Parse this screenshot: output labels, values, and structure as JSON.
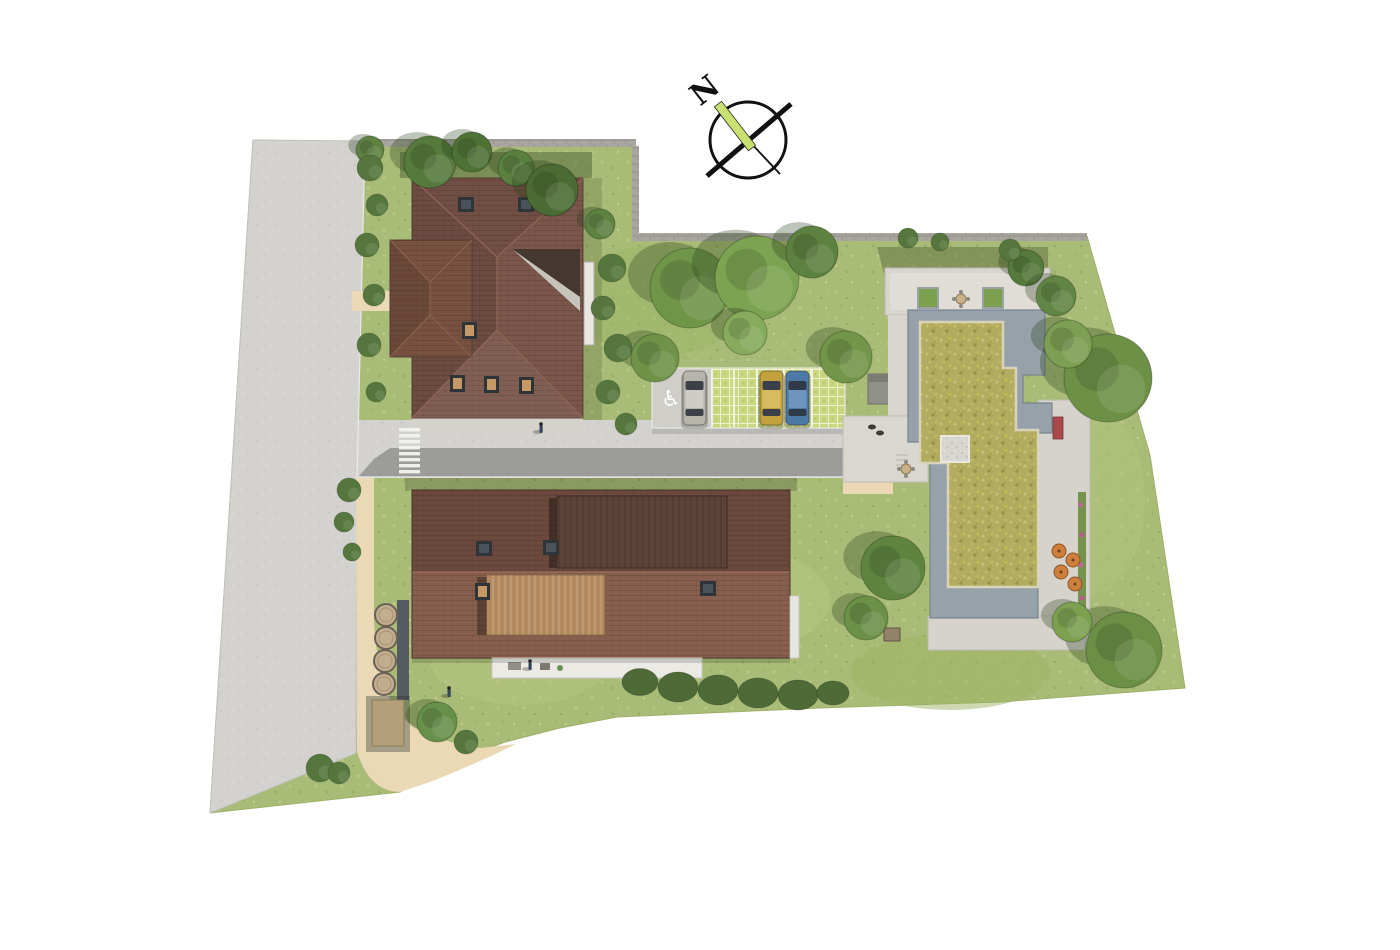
{
  "meta": {
    "description": "Aerial top-down 3D architectural site plan rendering of a residential development with two pitched-roof buildings, one flat green-roof building, access road, parking and gardens",
    "background": "#ffffff"
  },
  "compass": {
    "label": "N",
    "needle_color": "#c9e170",
    "ring_color": "#111111"
  },
  "palette": {
    "grass": "#a9bc77",
    "road": "#d3d2ce",
    "asphalt": "#9c9c9a",
    "path": "#ead9b4",
    "roof_main": "#7b564a",
    "roof_upper_b": "#6b4a3d",
    "roof_lower_b": "#875f4e",
    "roof_raised_dark": "#5c4237",
    "roof_raised_tan": "#b68c60",
    "flat_roof": "#97a1a9",
    "green_roof": "#b1ac5f",
    "terrace": "#d8d5ce",
    "wall": "#a8a69e",
    "hedge": "#4e6b37"
  },
  "parking": {
    "spaces": 6,
    "handicap_symbol": "♿",
    "divider_xs": [
      712,
      734,
      757,
      784,
      812
    ],
    "paver_color": "#cbd680",
    "crosswalk_stripes": 8
  },
  "cars": [
    {
      "name": "silver-car",
      "x": 683,
      "y": 371,
      "body": "#b7b4ac",
      "roof": "#cfccc5",
      "glass": "#3c4148"
    },
    {
      "name": "yellow-car",
      "x": 760,
      "y": 371,
      "body": "#c3a23e",
      "roof": "#d6bc5e",
      "glass": "#39404a"
    },
    {
      "name": "blue-car",
      "x": 786,
      "y": 371,
      "body": "#4d79a6",
      "roof": "#6d95bd",
      "glass": "#2f3a46"
    }
  ],
  "trees": [
    {
      "x": 430,
      "y": 162,
      "r": 26,
      "c": "#557a3b"
    },
    {
      "x": 472,
      "y": 152,
      "r": 20,
      "c": "#4e7136"
    },
    {
      "x": 516,
      "y": 168,
      "r": 18,
      "c": "#5a8040"
    },
    {
      "x": 552,
      "y": 190,
      "r": 26,
      "c": "#4a6c34"
    },
    {
      "x": 600,
      "y": 224,
      "r": 15,
      "c": "#5d8242"
    },
    {
      "x": 690,
      "y": 288,
      "r": 40,
      "c": "#6f9549"
    },
    {
      "x": 757,
      "y": 278,
      "r": 42,
      "c": "#7ba351"
    },
    {
      "x": 812,
      "y": 252,
      "r": 26,
      "c": "#5d8140"
    },
    {
      "x": 745,
      "y": 333,
      "r": 22,
      "c": "#86ab5c"
    },
    {
      "x": 655,
      "y": 358,
      "r": 24,
      "c": "#6e9348"
    },
    {
      "x": 846,
      "y": 357,
      "r": 26,
      "c": "#729649"
    },
    {
      "x": 1026,
      "y": 268,
      "r": 18,
      "c": "#567a3c"
    },
    {
      "x": 1056,
      "y": 296,
      "r": 20,
      "c": "#618544"
    },
    {
      "x": 1108,
      "y": 378,
      "r": 44,
      "c": "#6c9146"
    },
    {
      "x": 1068,
      "y": 344,
      "r": 24,
      "c": "#7d9f53"
    },
    {
      "x": 1124,
      "y": 650,
      "r": 38,
      "c": "#6a8f45"
    },
    {
      "x": 1072,
      "y": 622,
      "r": 20,
      "c": "#7aa050"
    },
    {
      "x": 893,
      "y": 568,
      "r": 32,
      "c": "#5f8440"
    },
    {
      "x": 866,
      "y": 618,
      "r": 22,
      "c": "#6b9048"
    },
    {
      "x": 437,
      "y": 722,
      "r": 20,
      "c": "#67904b"
    },
    {
      "x": 370,
      "y": 150,
      "r": 14,
      "c": "#5d8242"
    }
  ],
  "bushes": [
    {
      "x": 370,
      "y": 168,
      "r": 13
    },
    {
      "x": 377,
      "y": 205,
      "r": 11
    },
    {
      "x": 367,
      "y": 245,
      "r": 12
    },
    {
      "x": 374,
      "y": 295,
      "r": 11
    },
    {
      "x": 369,
      "y": 345,
      "r": 12
    },
    {
      "x": 376,
      "y": 392,
      "r": 10
    },
    {
      "x": 349,
      "y": 490,
      "r": 12
    },
    {
      "x": 344,
      "y": 522,
      "r": 10
    },
    {
      "x": 352,
      "y": 552,
      "r": 9
    },
    {
      "x": 612,
      "y": 268,
      "r": 14
    },
    {
      "x": 603,
      "y": 308,
      "r": 12
    },
    {
      "x": 618,
      "y": 348,
      "r": 14
    },
    {
      "x": 608,
      "y": 392,
      "r": 12
    },
    {
      "x": 626,
      "y": 424,
      "r": 11
    },
    {
      "x": 466,
      "y": 742,
      "r": 12
    },
    {
      "x": 320,
      "y": 768,
      "r": 14
    },
    {
      "x": 339,
      "y": 773,
      "r": 11
    },
    {
      "x": 908,
      "y": 238,
      "r": 10
    },
    {
      "x": 940,
      "y": 242,
      "r": 9
    },
    {
      "x": 1010,
      "y": 250,
      "r": 11
    }
  ],
  "hedge": [
    {
      "x": 640,
      "y": 682,
      "r": 18
    },
    {
      "x": 678,
      "y": 687,
      "r": 20
    },
    {
      "x": 718,
      "y": 690,
      "r": 20
    },
    {
      "x": 758,
      "y": 693,
      "r": 20
    },
    {
      "x": 798,
      "y": 695,
      "r": 20
    },
    {
      "x": 833,
      "y": 693,
      "r": 16
    }
  ],
  "tanks": {
    "radius": 11,
    "items": [
      {
        "x": 386,
        "y": 615
      },
      {
        "x": 386,
        "y": 638
      },
      {
        "x": 385,
        "y": 661
      },
      {
        "x": 384,
        "y": 684
      }
    ]
  },
  "skylights": {
    "dark": [
      {
        "x": 458,
        "y": 197
      },
      {
        "x": 518,
        "y": 197
      },
      {
        "x": 476,
        "y": 541
      },
      {
        "x": 543,
        "y": 540
      },
      {
        "x": 700,
        "y": 581
      }
    ],
    "tan": [
      {
        "x": 450,
        "y": 375
      },
      {
        "x": 484,
        "y": 376
      },
      {
        "x": 519,
        "y": 377
      },
      {
        "x": 462,
        "y": 322
      },
      {
        "x": 475,
        "y": 583
      }
    ]
  },
  "people": [
    {
      "x": 541,
      "y": 429
    },
    {
      "x": 449,
      "y": 693
    },
    {
      "x": 530,
      "y": 666
    }
  ],
  "pets": [
    {
      "x": 872,
      "y": 427
    },
    {
      "x": 880,
      "y": 433
    }
  ],
  "furniture": {
    "parasol_color": "#cf7f3c",
    "parasols": [
      {
        "x": 1059,
        "y": 551
      },
      {
        "x": 1073,
        "y": 560
      },
      {
        "x": 1061,
        "y": 572
      },
      {
        "x": 1075,
        "y": 584
      }
    ],
    "tables": [
      {
        "x": 961,
        "y": 299
      },
      {
        "x": 906,
        "y": 469
      }
    ],
    "planters": [
      {
        "x": 918,
        "y": 288
      },
      {
        "x": 983,
        "y": 288
      }
    ],
    "bench": {
      "x": 884,
      "y": 628
    }
  }
}
